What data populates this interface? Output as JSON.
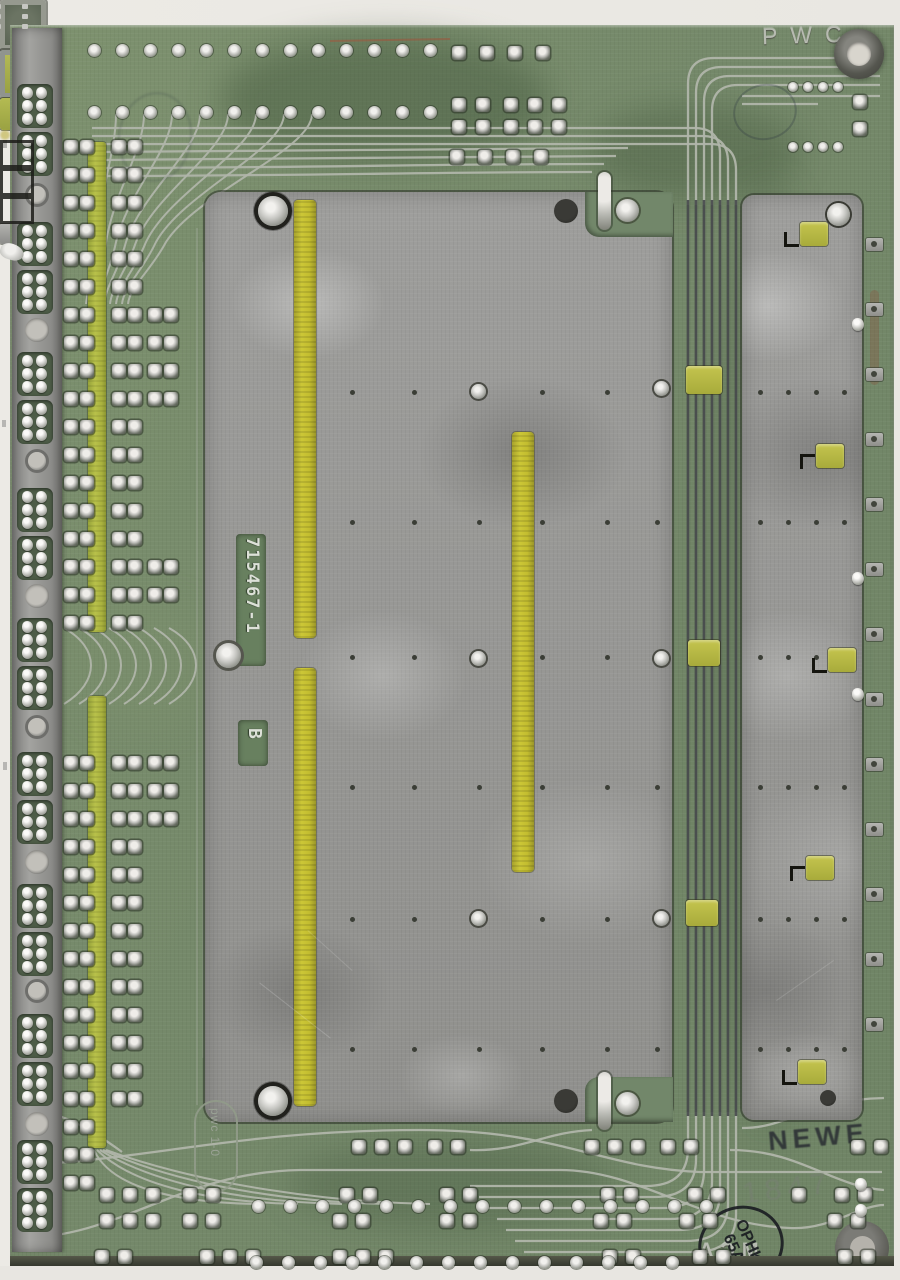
{
  "scene": {
    "subject": "Scanned solder side of a vintage printed circuit board with aluminum shield plates",
    "orientation": "portrait scan on white scanner background"
  },
  "colors": {
    "scan_background": "#ecebe6",
    "board_green": "#75896a",
    "board_green_dark": "#5d7254",
    "plate_gray": "#98988f",
    "rail_gray": "#90908e",
    "yellow_strip": "#c3bd2f",
    "yellow_green_strip": "#aab23e",
    "solder_silver": "#d6d6d2",
    "trace_silver": "#b0b5aa",
    "trace_dark": "#46484b",
    "pad_outline": "#3f4a3a",
    "ink_dark": "#2c2f35",
    "etched_metal": "#b7bbb1"
  },
  "markings": {
    "top_etched": "PWC",
    "part_number_window": "715467-1",
    "revision_window": "B",
    "etched_oval": "pwc 1-0",
    "ink_handstamp": "NEWE",
    "ink_faint_number": "1847",
    "round_stamp_line1": "OPHK",
    "round_stamp_line2": "65A",
    "etched_mirrored": "MCA"
  },
  "structure": {
    "edge_connector_cutout_pairs": 9,
    "rail_hole_count": 8,
    "channel_trace_count": 7,
    "right_edge_tab_count": 13,
    "top_round_pad_columns": 13,
    "main_plate_screw_count": 4,
    "yellow_strip_count_on_plate": 3
  }
}
